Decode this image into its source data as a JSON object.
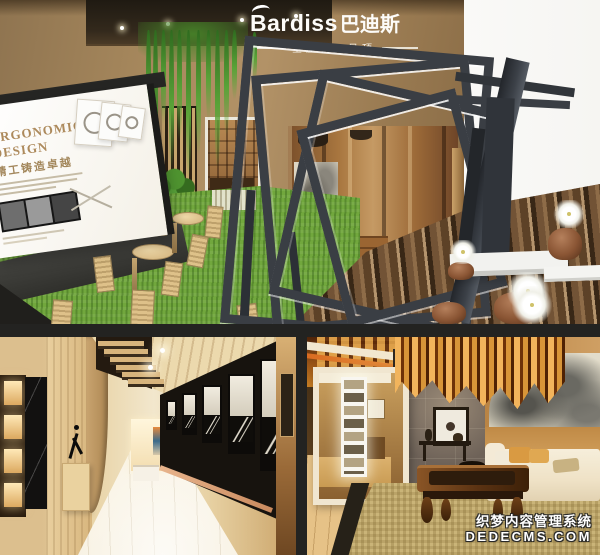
{
  "brand": {
    "logo_latin": "Bardiss",
    "logo_cjk": "巴迪斯",
    "tagline": "全屋精工吊顶"
  },
  "poster": {
    "title_line1": "ERGONOMIC",
    "title_line2": "DESIGN",
    "subtitle": "精工铸造卓越"
  },
  "watermark": {
    "line1": "织梦内容管理系统",
    "line2": "DEDECMS.COM"
  },
  "colors": {
    "background_gap": "#232321",
    "wall_tan": "#a5825a",
    "grass_green": "#71a73d",
    "frame_charcoal": "#3a3e44",
    "board_cream": "#f8f5ee",
    "poster_title_bronze": "#ad8a5c",
    "ceiling_amber": "#c87f24",
    "lattice_gold": "#d89538",
    "corridor_wood": "#e0c28d",
    "stone_wall_gray": "#6e6258",
    "watermark_white": "#ffffff"
  }
}
